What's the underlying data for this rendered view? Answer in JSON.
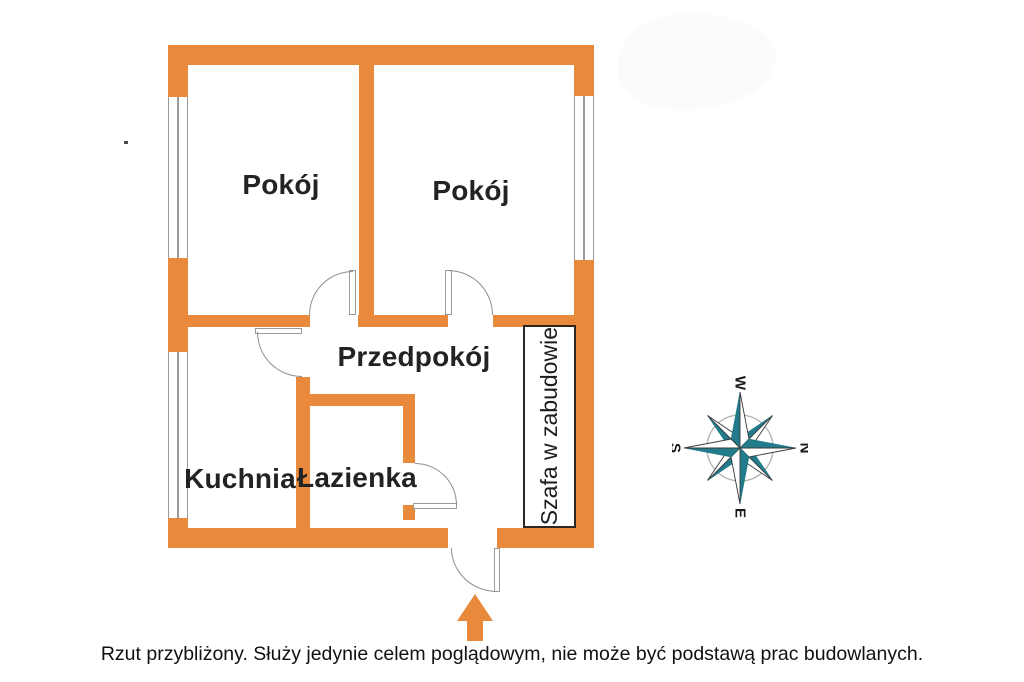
{
  "floorplan": {
    "rooms": {
      "room1": "Pokój",
      "room2": "Pokój",
      "hallway": "Przedpokój",
      "kitchen": "Kuchnia",
      "bathroom": "Łazienka",
      "wardrobe": "Szafa w zabudowie"
    },
    "compass": {
      "top": "W",
      "right": "N",
      "bottom": "E",
      "left": "S"
    },
    "caption": "Rzut przybliżony. Służy jedynie celem poglądowym, nie może być podstawą prac budowlanych.",
    "colors": {
      "wall": "#E8893C",
      "compass_star": "#217B8A",
      "door_window_line": "#9a9a9a",
      "wardrobe_border": "#2e2620",
      "text": "#232323"
    }
  }
}
